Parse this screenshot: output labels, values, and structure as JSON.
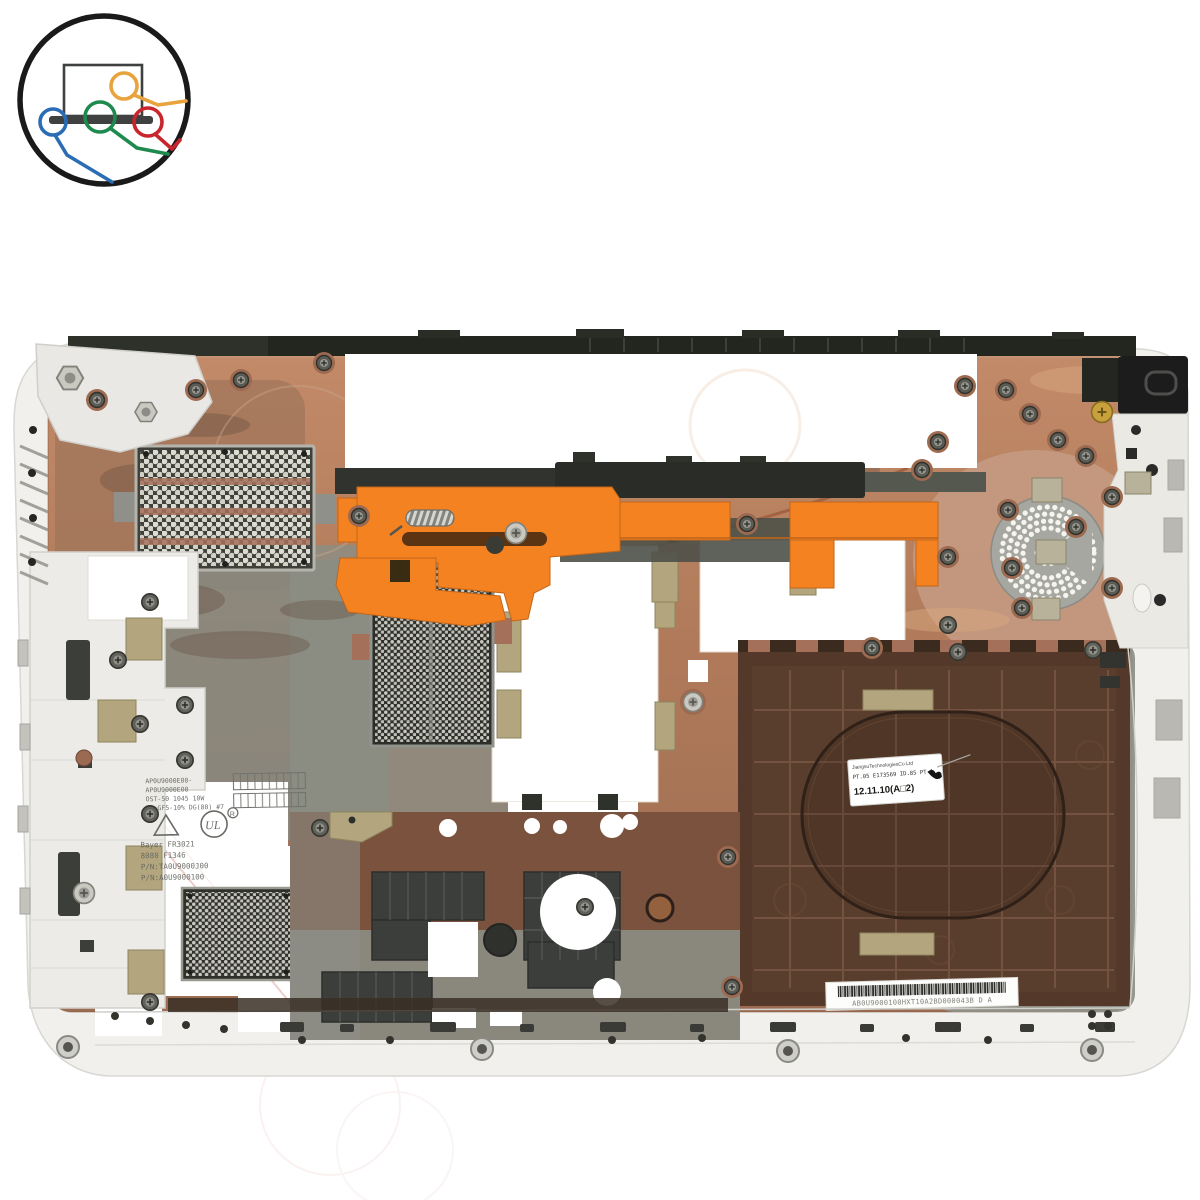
{
  "photo": {
    "subject": "laptop bottom base cover, interior view, white shell with copper EMI coating",
    "background": "#ffffff"
  },
  "logo": {
    "description": "laptop with colored cable connectors inside black circle",
    "circle_color": "#1a1a1a",
    "laptop_color": "#3f4040",
    "wire_orange": "#e5a33c",
    "wire_green": "#1f8a4d",
    "wire_blue": "#2a6db5",
    "wire_red": "#c9252c"
  },
  "part": {
    "molded_block_a": [
      "AP0U9000E00-",
      "AP0U9000E00",
      "OST-50 1045 10W",
      "PC+GF5-10% DG(80) #7"
    ],
    "molded_block_b": [
      "Bayer FR3021",
      "8080 F1346",
      "P/N:TA0U9000J00",
      "P/N:A0U9000100"
    ],
    "date_label": {
      "line1": "JiangsuTechnologiesCo.Ltd",
      "line2": "PT.05 E173569 ID.85 PT-1",
      "line3": "12.11.10(A□2)"
    },
    "barcode_label": {
      "text": "AB0U9000100HXT10A2BD000043B  D A"
    }
  },
  "colors": {
    "copper": "#b5805f",
    "copper_dark": "#8a5a44",
    "case_white": "#f1f0ec",
    "bay_brown": "#54392a",
    "panel_gray": "#8d9088",
    "orange": "#f58220",
    "mesh_dark": "#34352f",
    "gold_pad": "#b3a67e",
    "speaker_gray": "#a7a7a1",
    "label_white": "#ffffff"
  }
}
